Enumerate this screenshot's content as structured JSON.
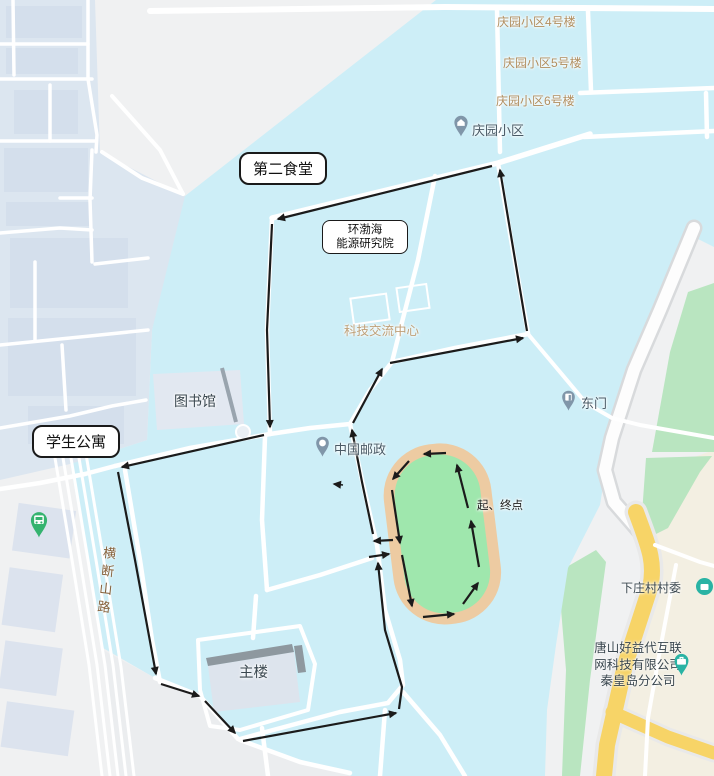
{
  "labels": {
    "qingyuan_b4": "庆园小区4号楼",
    "qingyuan_b5": "庆园小区5号楼",
    "qingyuan_b6": "庆园小区6号楼",
    "qingyuan": "庆园小区",
    "canteen2": "第二食堂",
    "institute_line1": "环渤海",
    "institute_line2": "能源研究院",
    "sci_center": "科技交流中心",
    "library": "图书馆",
    "dorm": "学生公寓",
    "east_gate": "东门",
    "china_post": "中国邮政",
    "start_finish": "起、终点",
    "road_hengduanshan": "横断山路",
    "village": "下庄村村委",
    "company_line1": "唐山好益代互联",
    "company_line2": "网科技有限公司",
    "company_line3": "秦皇岛分公司",
    "main_building": "主楼"
  },
  "colors": {
    "campus_fill": "#cdeef7",
    "residential_fill": "#dce6f0",
    "land_fill": "#f0f1f2",
    "beige_fill": "#f3efe2",
    "green_fill": "#b9e5c0",
    "track_field": "#9fe7ad",
    "track_ring": "#edcba2",
    "road_white": "#ffffff",
    "highway_yellow": "#f7d467",
    "route_black": "#1b1b1b",
    "poi_text": "#4a5a66",
    "area_text": "#b18e5f",
    "road_text": "#85603a",
    "pin_gray_blue": "#8096a9",
    "pin_green": "#35b36f",
    "pin_teal": "#29b3a4"
  }
}
